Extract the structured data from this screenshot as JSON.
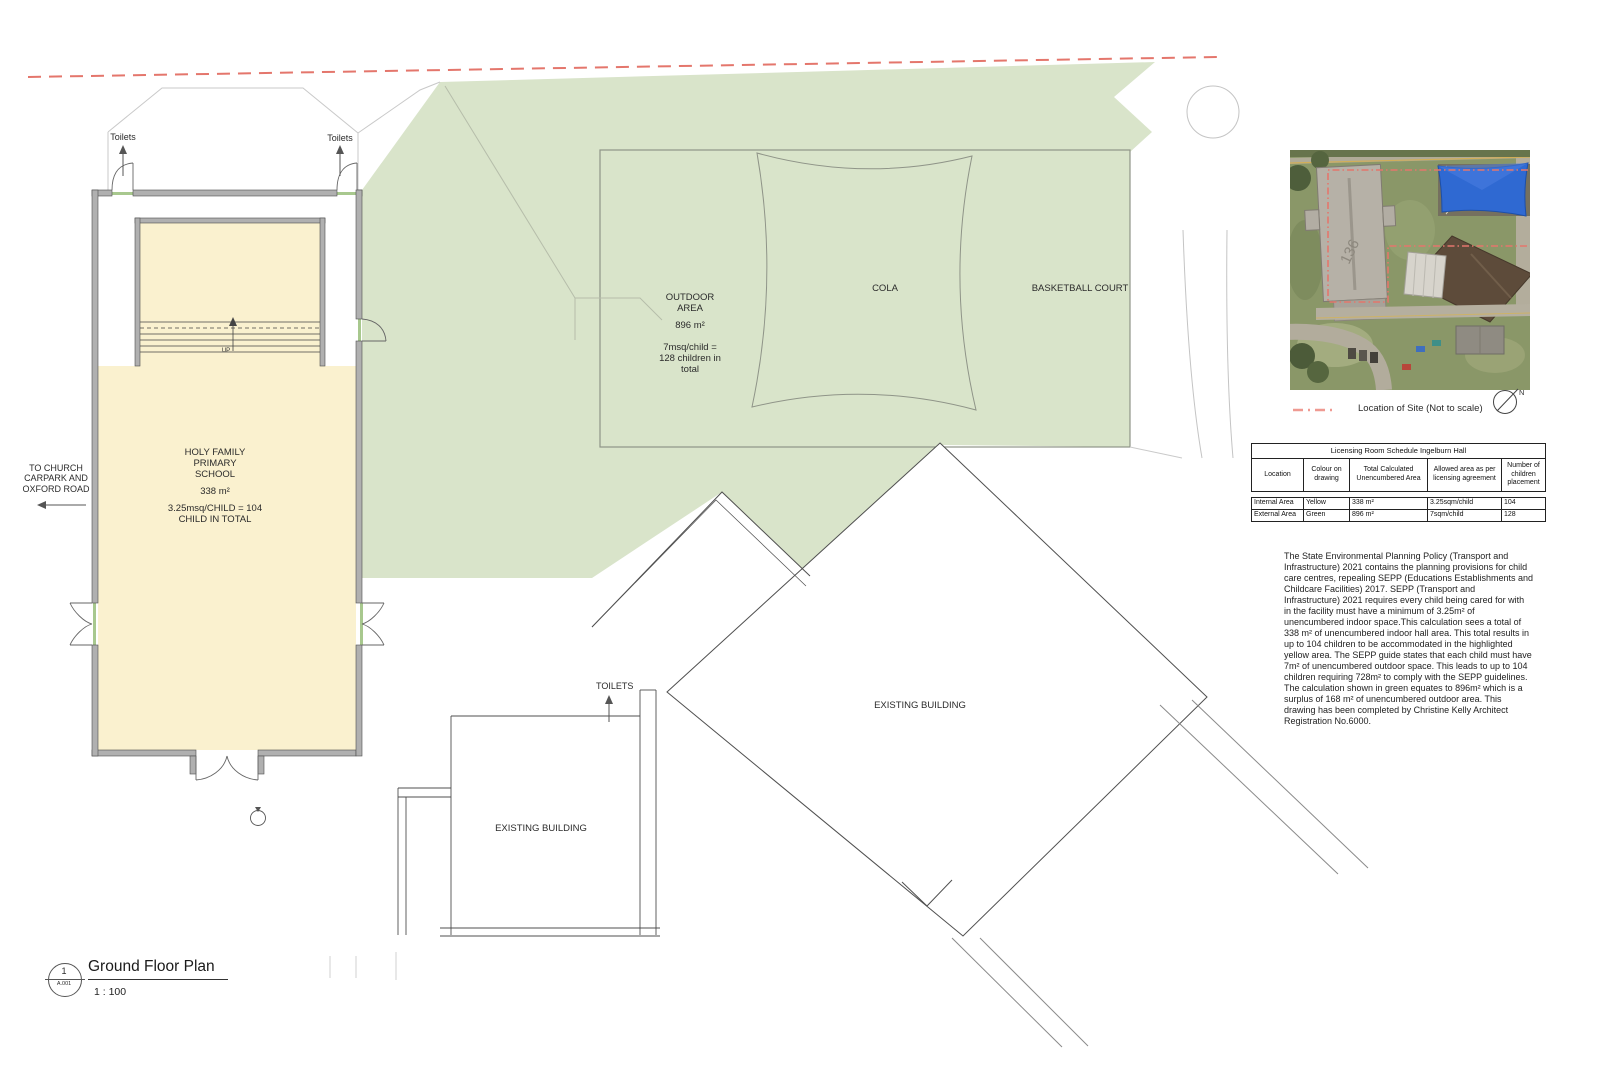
{
  "colors": {
    "internal_yellow": "#FAF1CF",
    "external_green": "#D9E4CA",
    "boundary_red": "#E4766C",
    "legend_red": "#EF9A92",
    "shade_sail_blue": "#2F69D2"
  },
  "plan": {
    "toilets": "Toilets",
    "toilets_caps": "TOILETS",
    "up_label": "UP",
    "church_note": "TO CHURCH\nCARPARK AND\nOXFORD ROAD",
    "hall_name": "HOLY FAMILY\nPRIMARY\nSCHOOL",
    "hall_area": "338 m²",
    "hall_calc": "3.25msq/CHILD = 104\nCHILD IN TOTAL",
    "outdoor_title": "OUTDOOR\nAREA",
    "outdoor_area": "896 m²",
    "outdoor_calc": "7msq/child =\n128 children in\ntotal",
    "cola": "COLA",
    "basketball_court": "BASKETBALL COURT",
    "existing_building_upper": "EXISTING BUILDING",
    "existing_building_lower": "EXISTING BUILDING"
  },
  "site_panel": {
    "aerial_roof_number": "136",
    "legend_label": "Location of Site (Not to scale)",
    "north_label": "N"
  },
  "licensing_table": {
    "title": "Licensing Room Schedule Ingelburn Hall",
    "headers": [
      "Location",
      "Colour on\ndrawing",
      "Total Calculated\nUnencumbered Area",
      "Allowed area as per\nlicensing agreement",
      "Number of\nchildren\nplacement"
    ],
    "rows": [
      [
        "Internal Area",
        "Yellow",
        "338 m²",
        "3.25sqm/child",
        "104"
      ],
      [
        "External Area",
        "Green",
        "896 m²",
        "7sqm/child",
        "128"
      ]
    ]
  },
  "notes": {
    "paragraph": "The State Environmental Planning Policy (Transport and Infrastructure) 2021 contains the planning provisions for child care centres, repealing SEPP (Educations Establishments and Childcare Facilities) 2017. SEPP (Transport and Infrastructure) 2021 requires every child being cared for with in the facility must have a minimum of 3.25m² of unencumbered indoor space.This calculation sees a total of 338 m² of unencumbered indoor hall area. This total results in up to 104 children to be accommodated in the highlighted yellow area. The SEPP guide states that each child must have 7m² of unencumbered outdoor space. This leads to up to 104 children requiring 728m² to comply with the SEPP guidelines. The calculation shown in green equates to 896m² which is a surplus of 168 m² of unencumbered outdoor area. This drawing has been completed by Christine Kelly Architect Registration No.6000."
  },
  "title_block": {
    "detail_number": "1",
    "sheet_number": "A.001",
    "title": "Ground Floor Plan",
    "scale": "1 : 100"
  }
}
